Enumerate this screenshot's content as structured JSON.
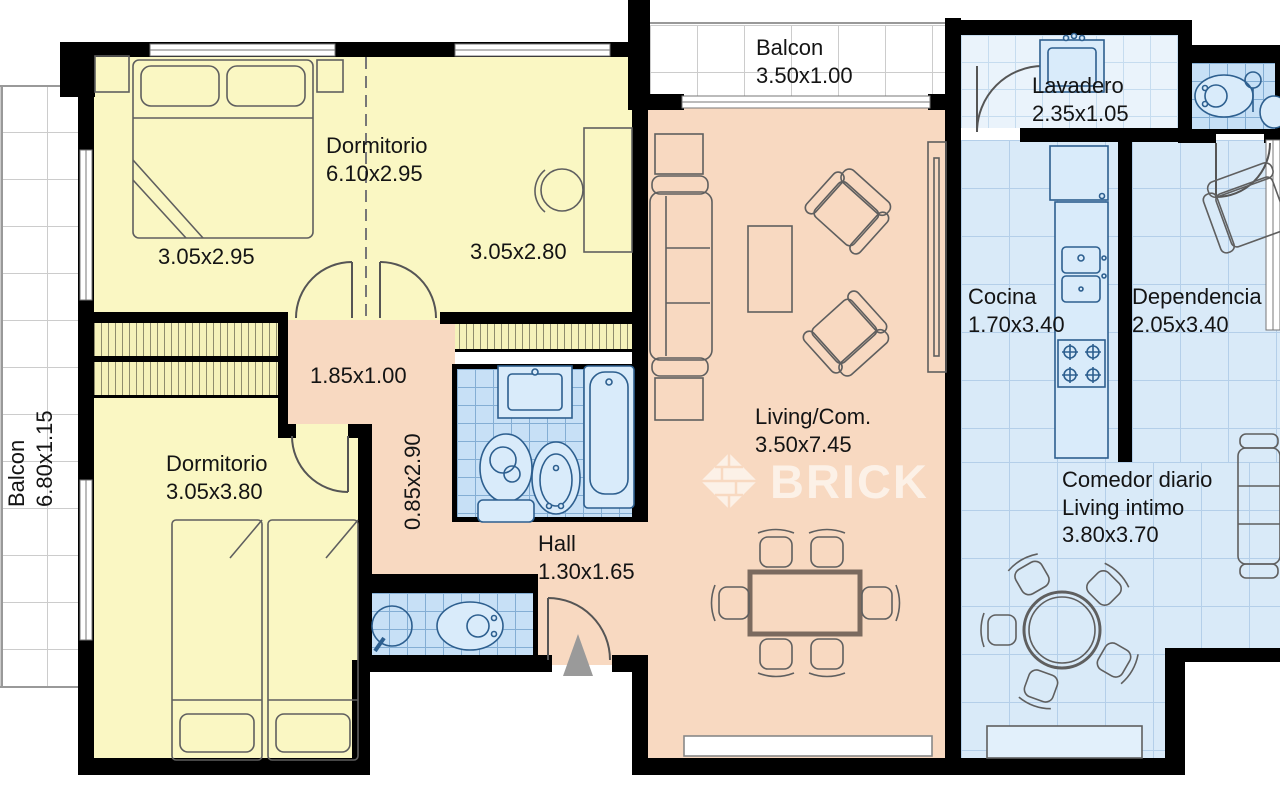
{
  "watermark": {
    "brand": "BRICK"
  },
  "rooms": {
    "balcon_left": {
      "name": "Balcon",
      "dims": "6.80x1.15"
    },
    "balcon_superior": {
      "name": "Balcon",
      "dims": "3.50x1.00"
    },
    "dormitorio_principal": {
      "name": "Dormitorio",
      "dims": "6.10x2.95",
      "sub_left": "3.05x2.95",
      "sub_right": "3.05x2.80"
    },
    "dormitorio_secundario": {
      "name": "Dormitorio",
      "dims": "3.05x3.80"
    },
    "pasillo_horizontal": {
      "dims": "1.85x1.00"
    },
    "pasillo_vertical": {
      "dims": "0.85x2.90"
    },
    "hall": {
      "name": "Hall",
      "dims": "1.30x1.65"
    },
    "living_comedor": {
      "name": "Living/Com.",
      "dims": "3.50x7.45"
    },
    "lavadero": {
      "name": "Lavadero",
      "dims": "2.35x1.05"
    },
    "cocina": {
      "name": "Cocina",
      "dims": "1.70x3.40"
    },
    "dependencia": {
      "name": "Dependencia",
      "dims": "2.05x3.40"
    },
    "comedor_diario": {
      "name": "Comedor diario",
      "name2": "Living intimo",
      "dims": "3.80x3.70"
    }
  },
  "colors": {
    "bedroom": "#faf7c3",
    "living": "#f8d9c1",
    "wet_tile": "#c7e0f6",
    "service_tile": "#d9eaf8",
    "balcony": "#ffffff",
    "wall": "#000000",
    "fixture_line": "#2d5f8f",
    "watermark": "rgba(255,255,255,0.62)"
  }
}
